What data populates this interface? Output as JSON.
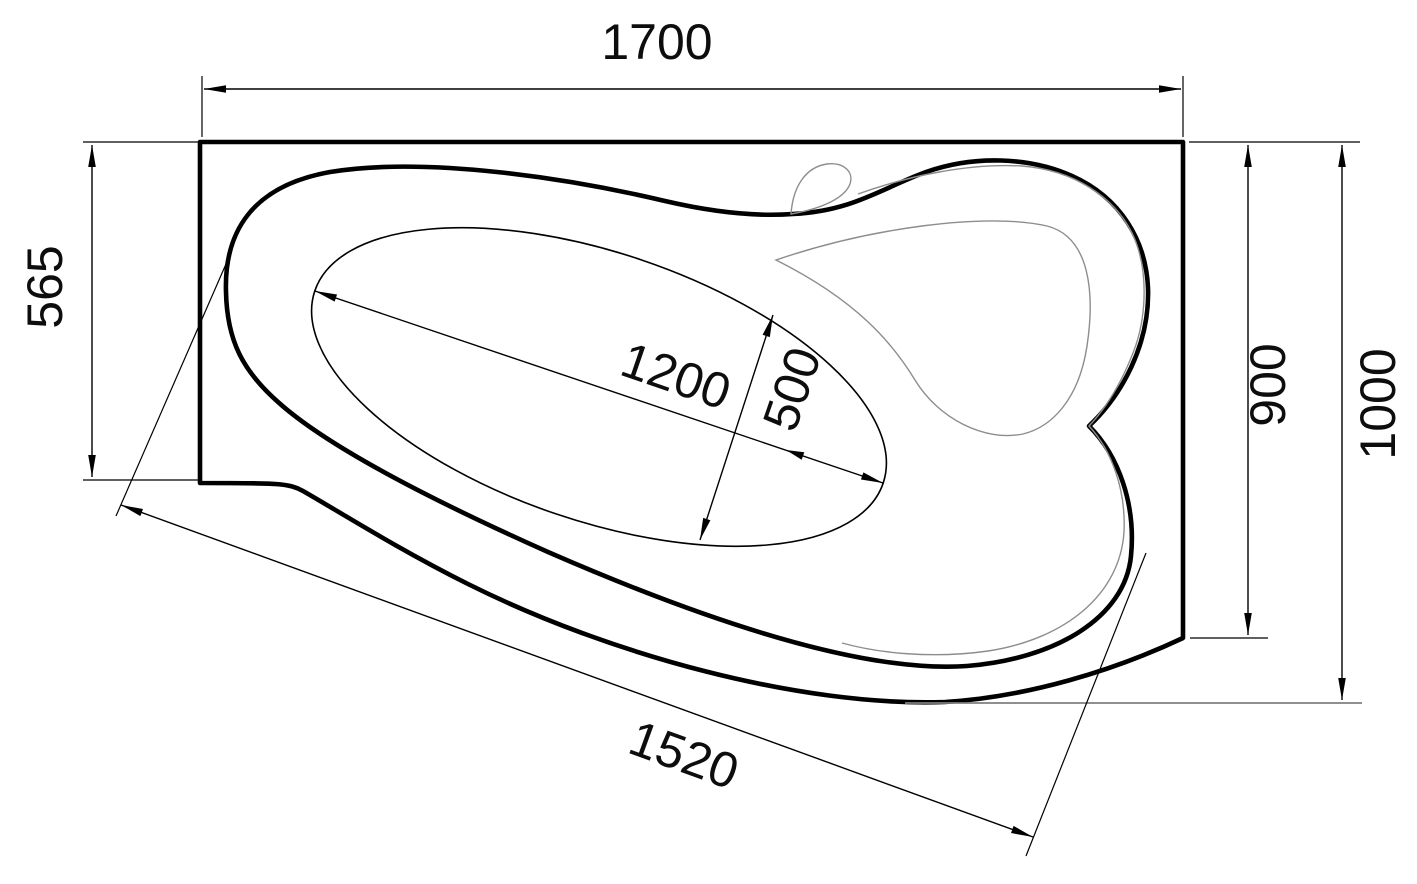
{
  "drawing": {
    "kind": "bathtub-top-view-technical-drawing"
  },
  "dimensions": {
    "overall_length": {
      "label": "1700"
    },
    "left_end_width": {
      "label": "565"
    },
    "bowl_length": {
      "label": "1200"
    },
    "bowl_width": {
      "label": "500"
    },
    "right_rim_width": {
      "label": "900"
    },
    "overall_width": {
      "label": "1000"
    },
    "front_edge_length": {
      "label": "1520"
    }
  },
  "colors": {
    "primary_line": "#000000",
    "secondary_line": "#8d8d8d",
    "background": "#ffffff"
  }
}
